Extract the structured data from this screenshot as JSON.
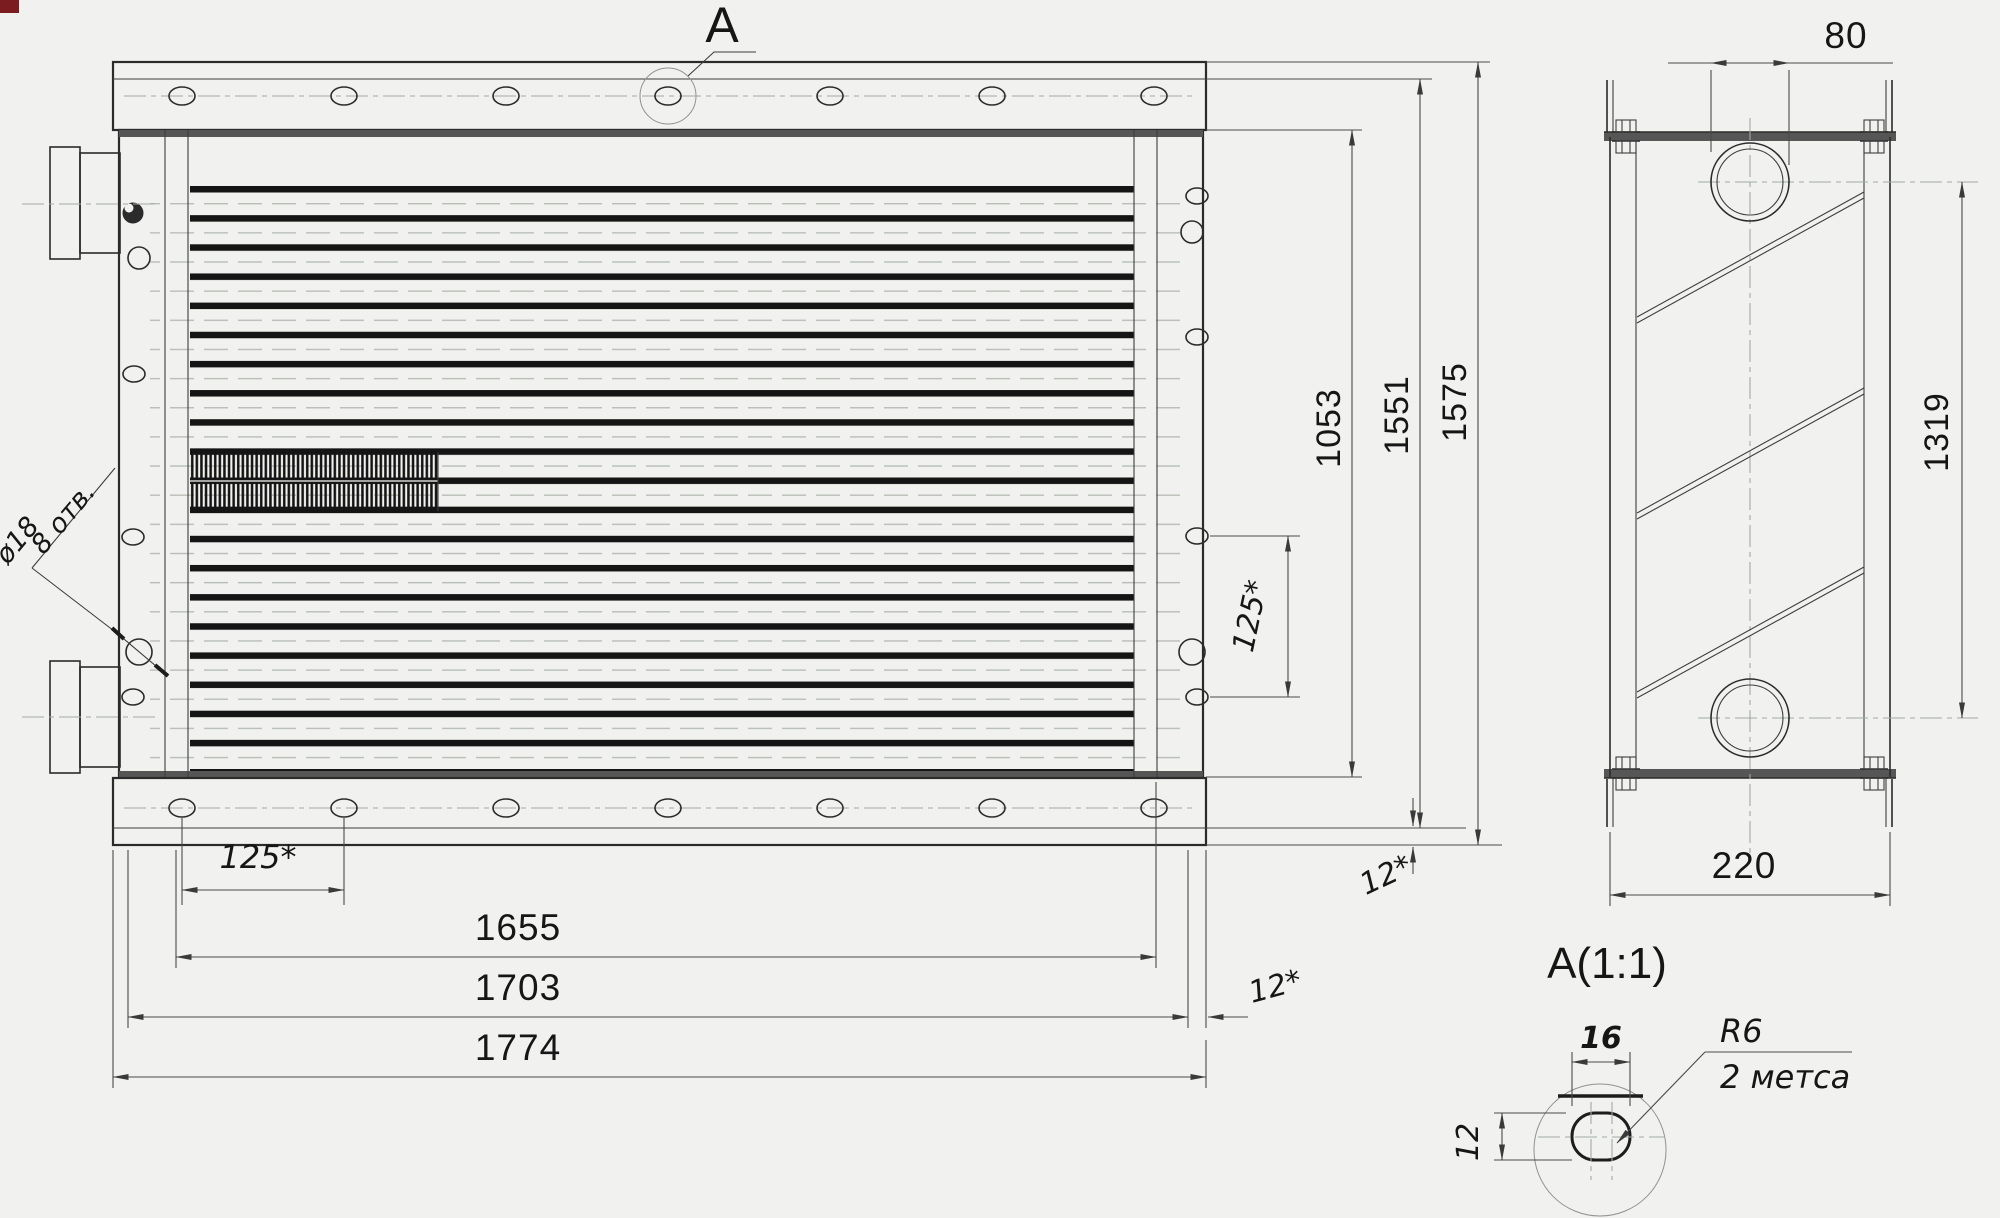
{
  "front_view": {
    "section_marker": "A",
    "hole_diameter_callout": "ø18",
    "hole_count_callout": "8 отв.",
    "dims": {
      "core_height": "1053",
      "inner_height": "1551",
      "overall_height": "1575",
      "hole_pitch_right": "125*",
      "hole_pitch_bottom": "125*",
      "tube_length": "1655",
      "body_width": "1703",
      "overall_width": "1774",
      "flange_offset_horizontal": "12*",
      "flange_offset_vertical": "12*"
    }
  },
  "side_view": {
    "dims": {
      "pipe_offset_top": "80",
      "pipe_center_distance": "1319",
      "depth": "220"
    }
  },
  "detail_view": {
    "title": "A(1:1)",
    "dims": {
      "slot_width": "16",
      "slot_height": "12"
    },
    "radius_callout": "R6",
    "places_note": "2 метса"
  },
  "colors": {
    "line": "#2b2b2b",
    "centerline": "#a3aaa1",
    "background": "#f1f1ef",
    "corner_artifact": "#7b1d20"
  }
}
